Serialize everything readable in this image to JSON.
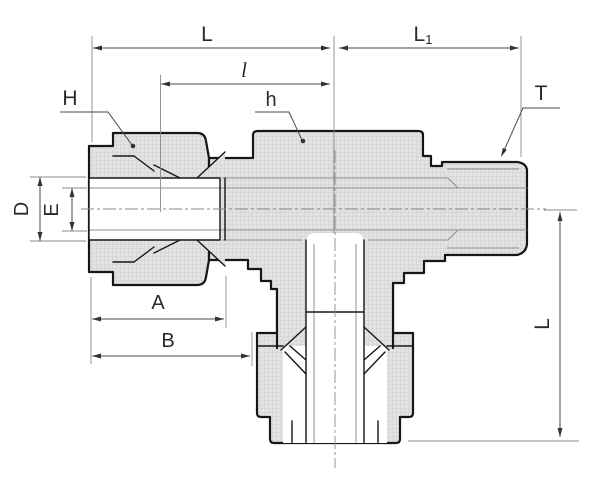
{
  "drawing": {
    "kind": "male-branch-tee tube fitting cross-section",
    "colors": {
      "background": "#ffffff",
      "outline": "#161616",
      "section_fill": "#e2e2e2",
      "dimension_lines": "#4a4a4a",
      "label_text": "#2a2a2a"
    },
    "dims": {
      "overall_top_span": "L",
      "inner_top_span": "l",
      "right_top_span_base": "L",
      "right_top_span_sub": "1",
      "thread_callout": "T",
      "nut_hex_callout": "H",
      "body_hex_callout": "h",
      "outer_bore": "D",
      "inner_bore": "E",
      "nut_length": "A",
      "to_branch_length": "B",
      "branch_vertical_span": "L"
    }
  }
}
